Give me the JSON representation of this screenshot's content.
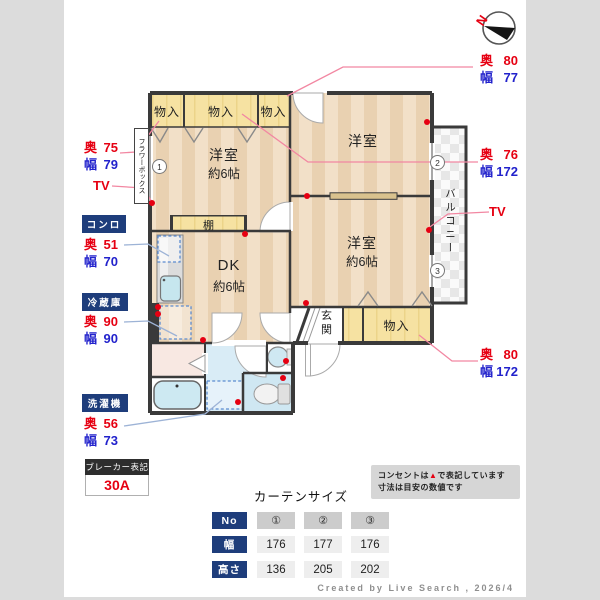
{
  "palette": {
    "accent_red": "#e60012",
    "accent_blue": "#2222cc",
    "badge_bg": "#1e3d7b",
    "wall": "#3a3a3a"
  },
  "compass": {
    "n": "N"
  },
  "rooms": {
    "closet1": "物入",
    "closet2": "物入",
    "closet3": "物入",
    "closet_bottom": "物入",
    "bedroom_left": {
      "name": "洋室",
      "size": "約6帖"
    },
    "bedroom_top": {
      "name": "洋室"
    },
    "bedroom_right": {
      "name": "洋室",
      "size": "約6帖"
    },
    "dk": {
      "name": "DK",
      "size": "約6帖"
    },
    "shelf": "棚",
    "entrance": "玄関",
    "balcony": "バルコニー",
    "flower_box": "フラワーボックス"
  },
  "markers": [
    "1",
    "2",
    "3"
  ],
  "annotations": {
    "closet1_dims": {
      "l1": "奥",
      "v1": "75",
      "l2": "幅",
      "v2": "79"
    },
    "closet2_dims": {
      "l1": "奥",
      "v1": "76",
      "l2": "幅",
      "v2": "172"
    },
    "closet3_dims": {
      "l1": "奥",
      "v1": "80",
      "l2": "幅",
      "v2": "77"
    },
    "closet_bottom_dims": {
      "l1": "奥",
      "v1": "80",
      "l2": "幅",
      "v2": "172"
    },
    "tv_left": "TV",
    "tv_right": "TV",
    "stove": {
      "badge": "コンロ",
      "l1": "奥",
      "v1": "51",
      "l2": "幅",
      "v2": "70"
    },
    "fridge": {
      "badge": "冷蔵庫",
      "l1": "奥",
      "v1": "90",
      "l2": "幅",
      "v2": "90"
    },
    "washer": {
      "badge": "洗濯機",
      "l1": "奥",
      "v1": "56",
      "l2": "幅",
      "v2": "73"
    },
    "breaker": {
      "title": "ブレーカー表記",
      "value": "30A"
    }
  },
  "notice": {
    "line1_pre": "コンセントは",
    "line1_mark": "▲",
    "line1_post": "で表記しています",
    "line2": "寸法は目安の数値です"
  },
  "curtain_table": {
    "title": "カーテンサイズ",
    "row_headers": [
      "No",
      "幅",
      "高さ"
    ],
    "no_row": [
      "①",
      "②",
      "③"
    ],
    "width_row": [
      "176",
      "177",
      "176"
    ],
    "height_row": [
      "136",
      "205",
      "202"
    ]
  },
  "credit": "Created by Live Search , 2026/4"
}
